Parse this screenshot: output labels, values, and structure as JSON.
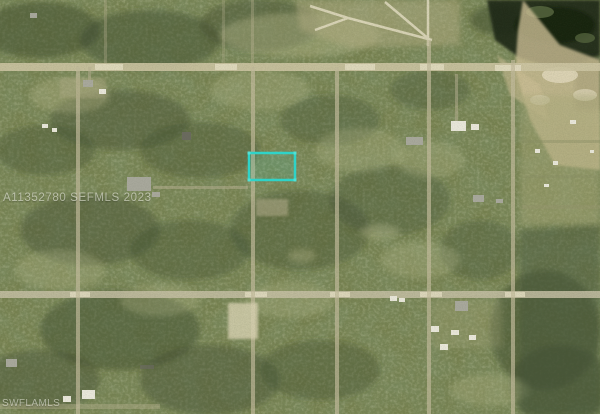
{
  "watermarks": {
    "mls": "A11352780 SEFMLS 2023",
    "source": "SWFLAMLS"
  },
  "map": {
    "type": "satellite-aerial-parcel-map",
    "subject_parcel_outline_color": "#2fd3c8",
    "colors": {
      "vegetation": "#76814f",
      "dark_trees": "#3b4a2e",
      "light_brush": "#b6b88a",
      "road": "#ccc4a2",
      "road_bright": "#e3ddc2",
      "sand": "#cdbf96",
      "water": "#1c2817",
      "cleared_lot": "#d9d2b2",
      "structure_white": "#e9e7da",
      "structure_gray": "#a8a89c"
    }
  }
}
